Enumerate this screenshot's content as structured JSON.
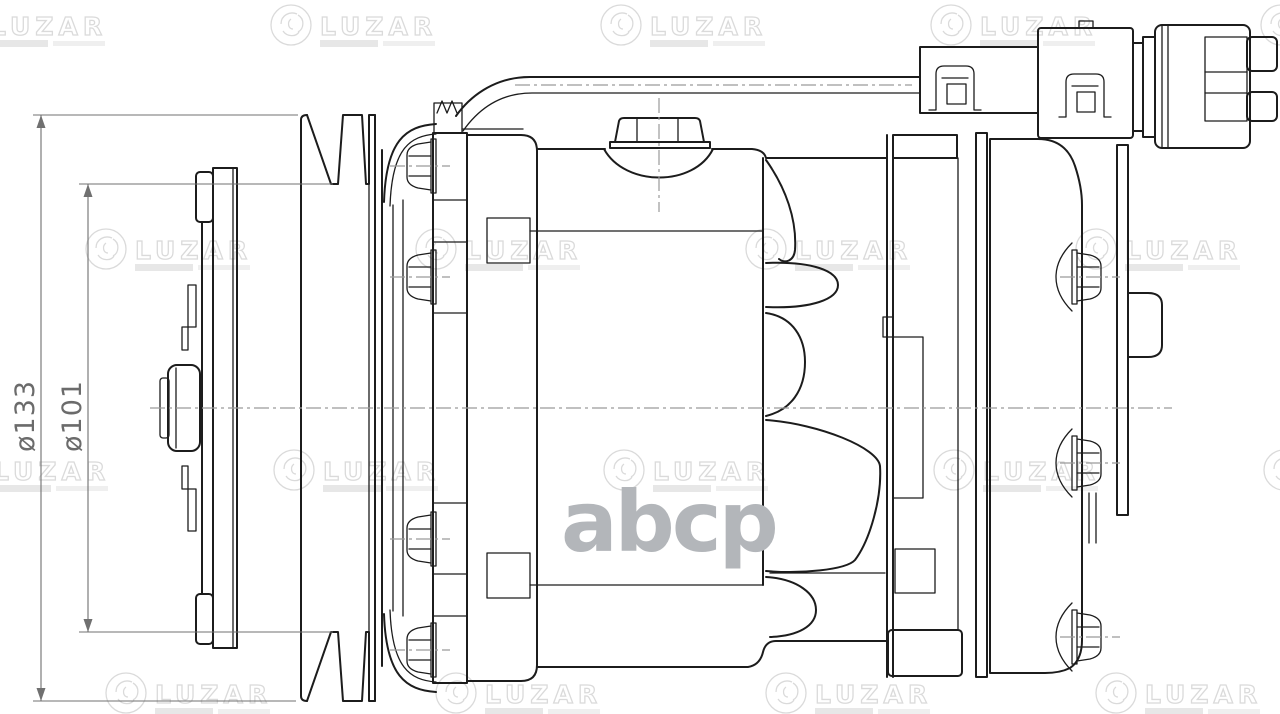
{
  "drawing": {
    "description_labels": {
      "outer_diameter": "ø133",
      "groove_diameter": "ø101"
    },
    "watermarks": {
      "brand": "LUZAR",
      "center": "abcp"
    },
    "colors": {
      "line": "#1c1c1c",
      "centerline": "#9a9a9a",
      "dimension": "#707070",
      "watermark_stroke": "#d9d9d9",
      "watermark_bar": "#e6e6e6",
      "center_watermark": "#b3b6ba",
      "background": "#ffffff"
    }
  }
}
